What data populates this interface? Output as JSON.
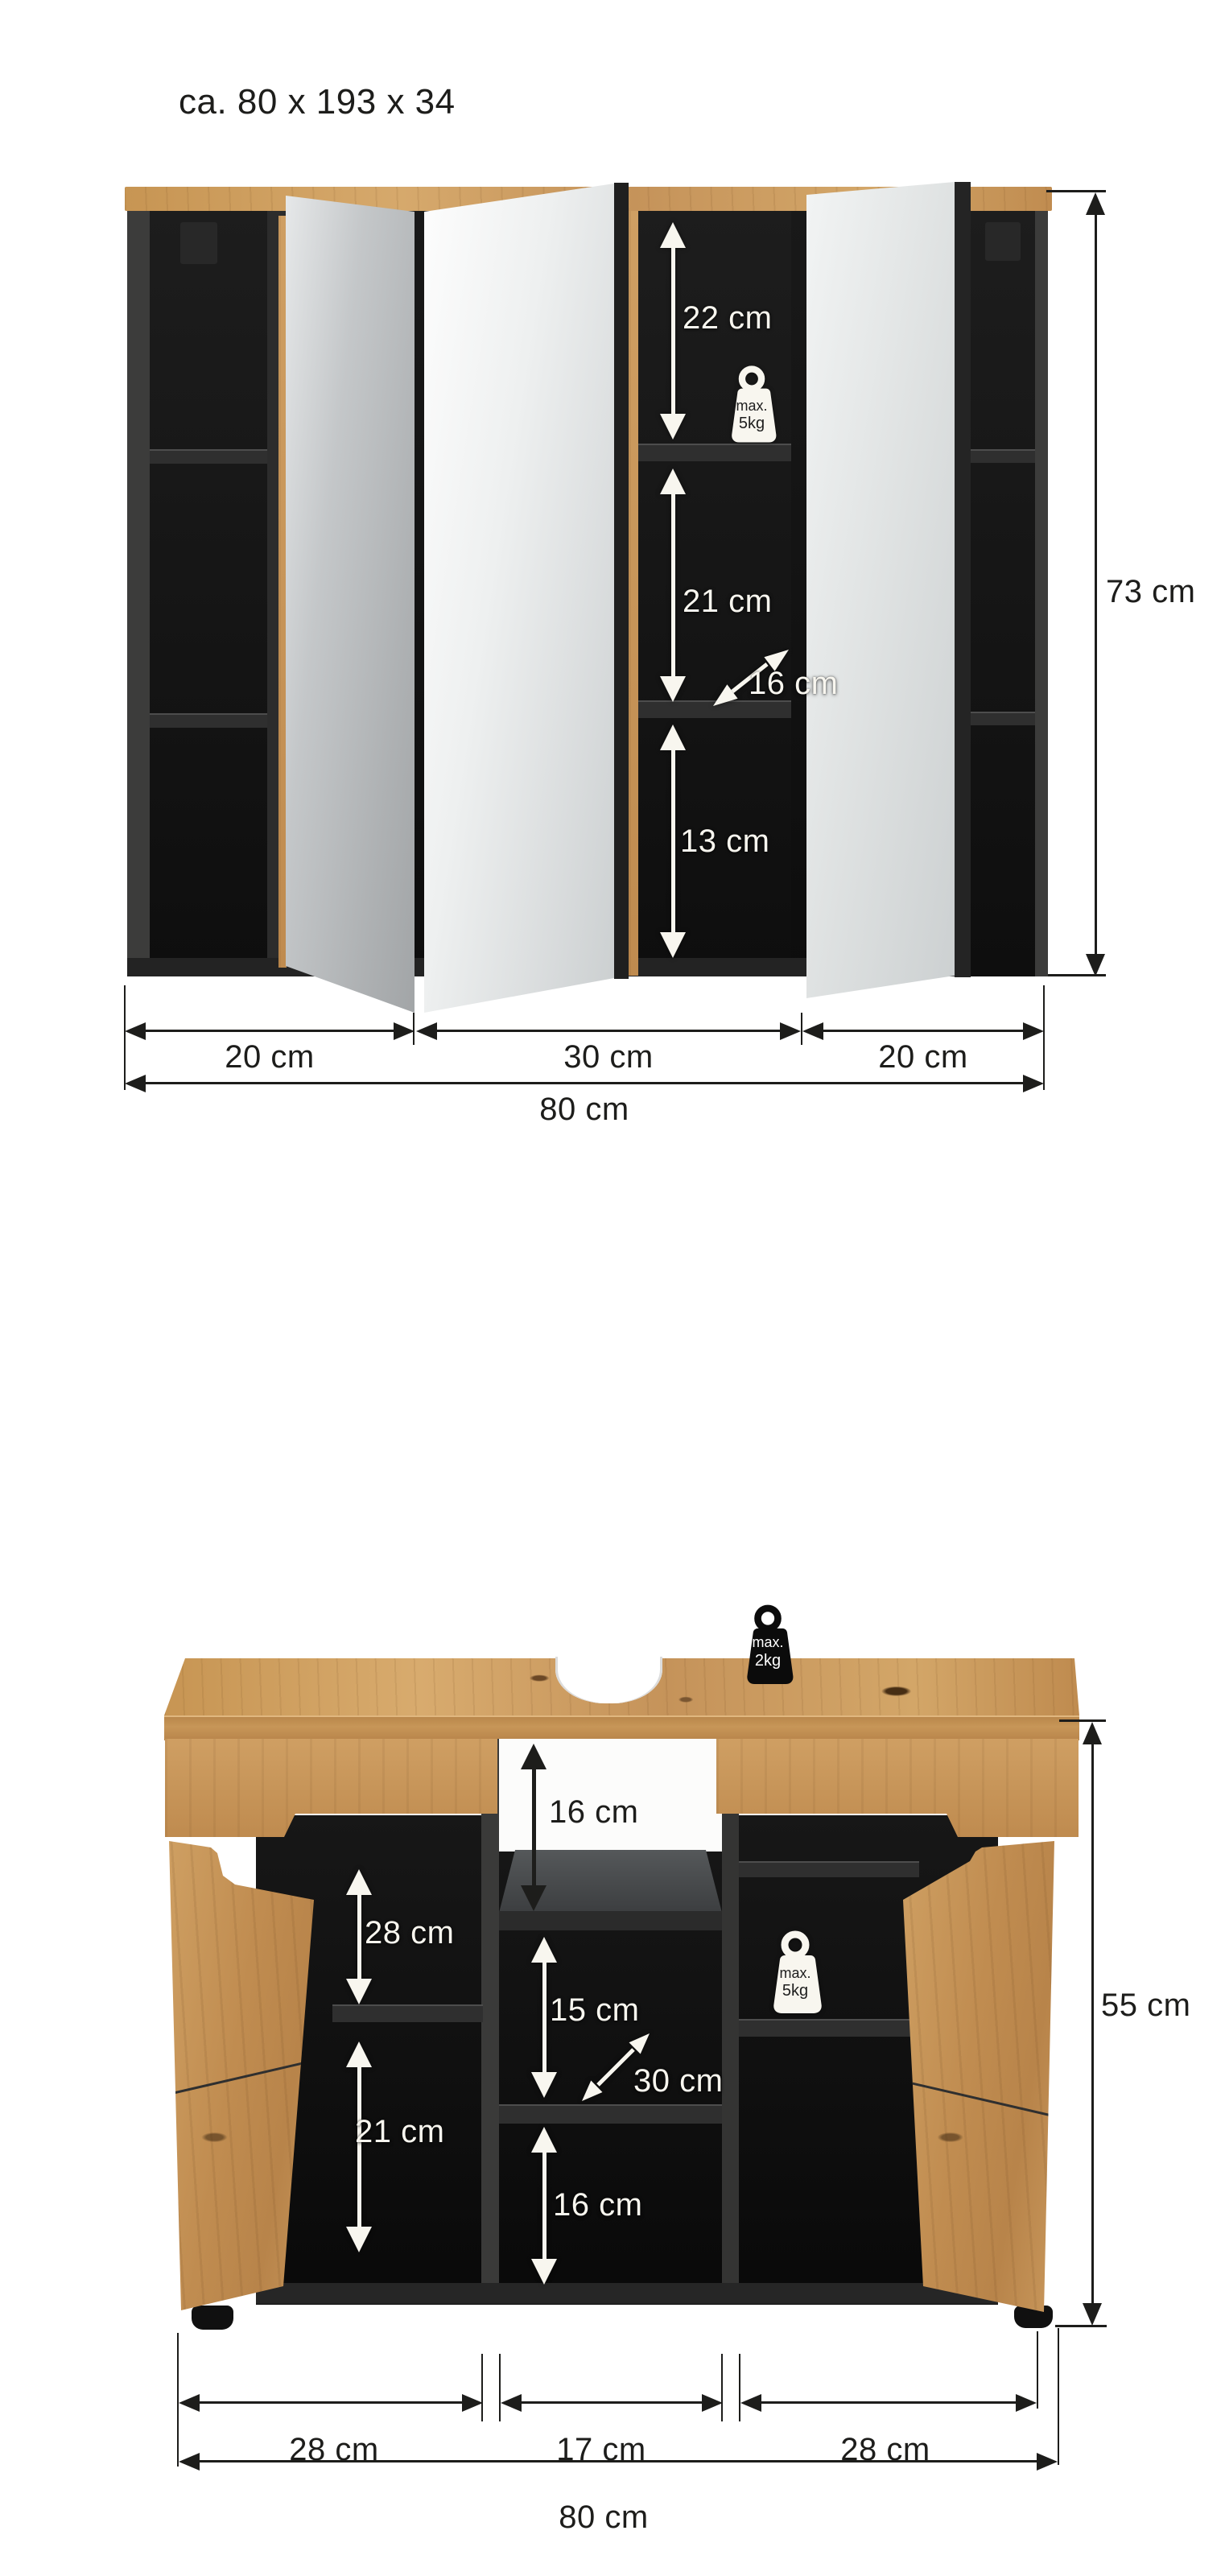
{
  "title": "ca. 80 x 193 x 34",
  "mirror_cabinet": {
    "section_top": "22 cm",
    "section_middle": "21 cm",
    "depth": "16 cm",
    "section_bottom": "13 cm",
    "height": "73 cm",
    "width_left": "20 cm",
    "width_center": "30 cm",
    "width_right": "20 cm",
    "width_total": "80 cm",
    "max_load_shelf": {
      "line1": "max.",
      "line2": "5kg"
    }
  },
  "vanity_cabinet": {
    "siphon_cutout": "16 cm",
    "left_top": "28 cm",
    "left_bottom": "21 cm",
    "center_top": "15 cm",
    "depth": "30 cm",
    "center_bottom": "16 cm",
    "height": "55 cm",
    "width_left": "28 cm",
    "width_center": "17 cm",
    "width_right": "28 cm",
    "width_total": "80 cm",
    "max_load_top": {
      "line1": "max.",
      "line2": "2kg"
    },
    "max_load_shelf": {
      "line1": "max.",
      "line2": "5kg"
    }
  },
  "colors": {
    "oak": "#c9985c",
    "anthracite": "#3b3b3a",
    "dim_dark": "#1d1d1b",
    "dim_light": "#f8f6ef"
  }
}
